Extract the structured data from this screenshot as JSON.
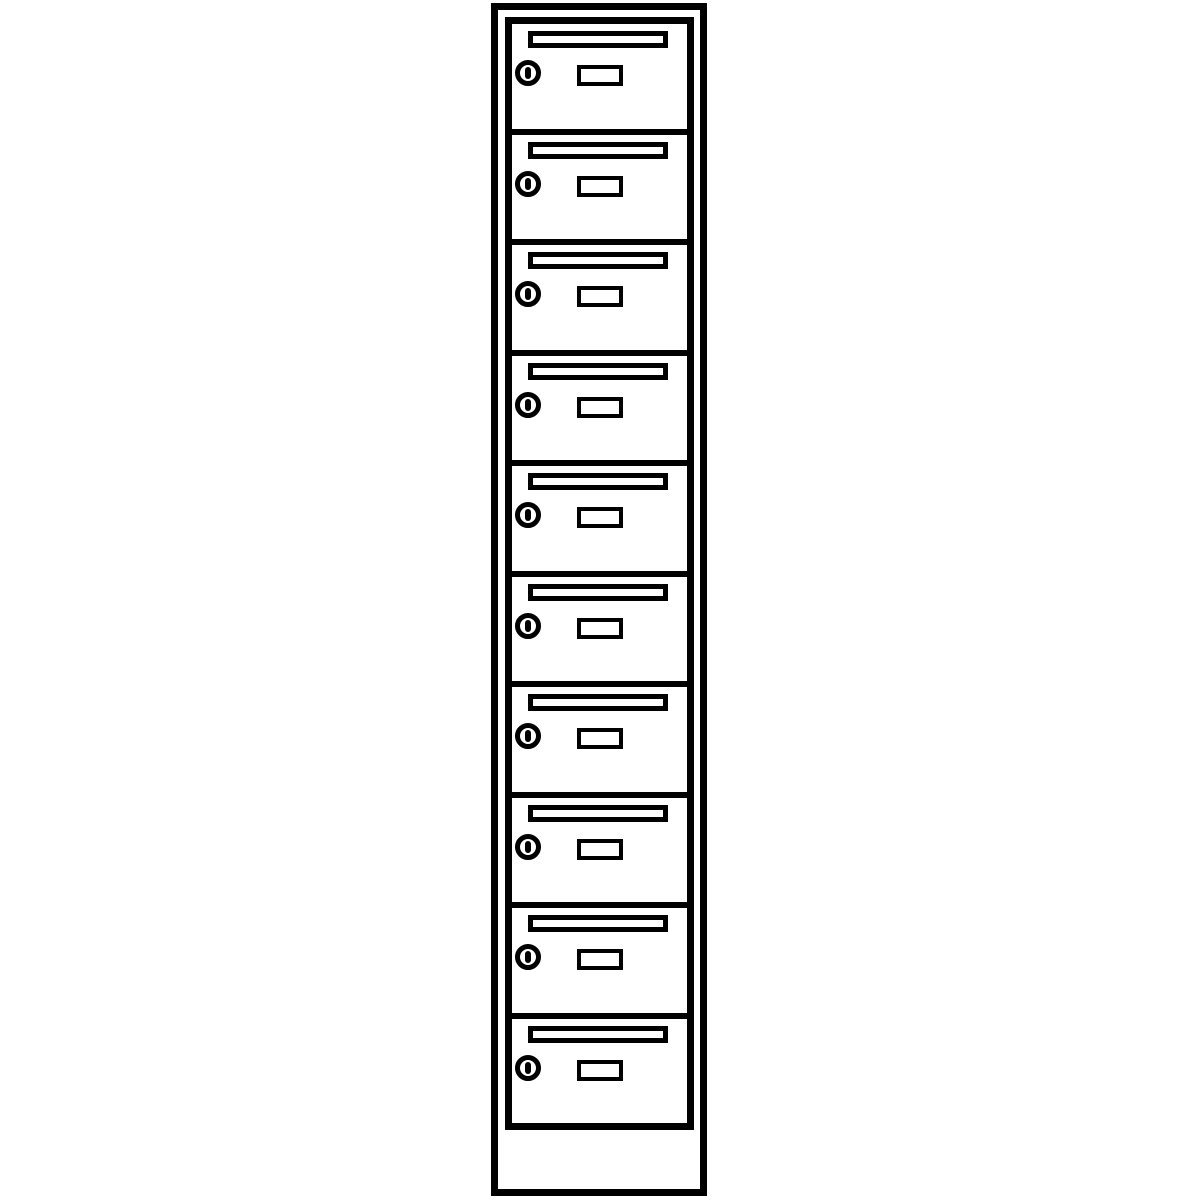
{
  "page": {
    "background_color": "#ffffff",
    "description": "Black-and-white line drawing of a tall single-column mailbox locker cabinet with ten lockable mail compartments above an empty plinth base"
  },
  "cabinet": {
    "name": "mailbox-locker-column",
    "line_color": "#000000",
    "fill_color": "#ffffff",
    "compartment_count": 10,
    "compartments": [
      {
        "id": 1
      },
      {
        "id": 2
      },
      {
        "id": 3
      },
      {
        "id": 4
      },
      {
        "id": 5
      },
      {
        "id": 6
      },
      {
        "id": 7
      },
      {
        "id": 8
      },
      {
        "id": 9
      },
      {
        "id": 10
      }
    ],
    "compartment_features": {
      "mail_slot_icon": "horizontal letter slot opening with thick frame",
      "keyhole_lock_icon": "round cylinder lock with vertical keyhole bar",
      "name_plate": "small empty rectangular label holder"
    },
    "base": {
      "name": "plinth-base",
      "content": ""
    }
  }
}
